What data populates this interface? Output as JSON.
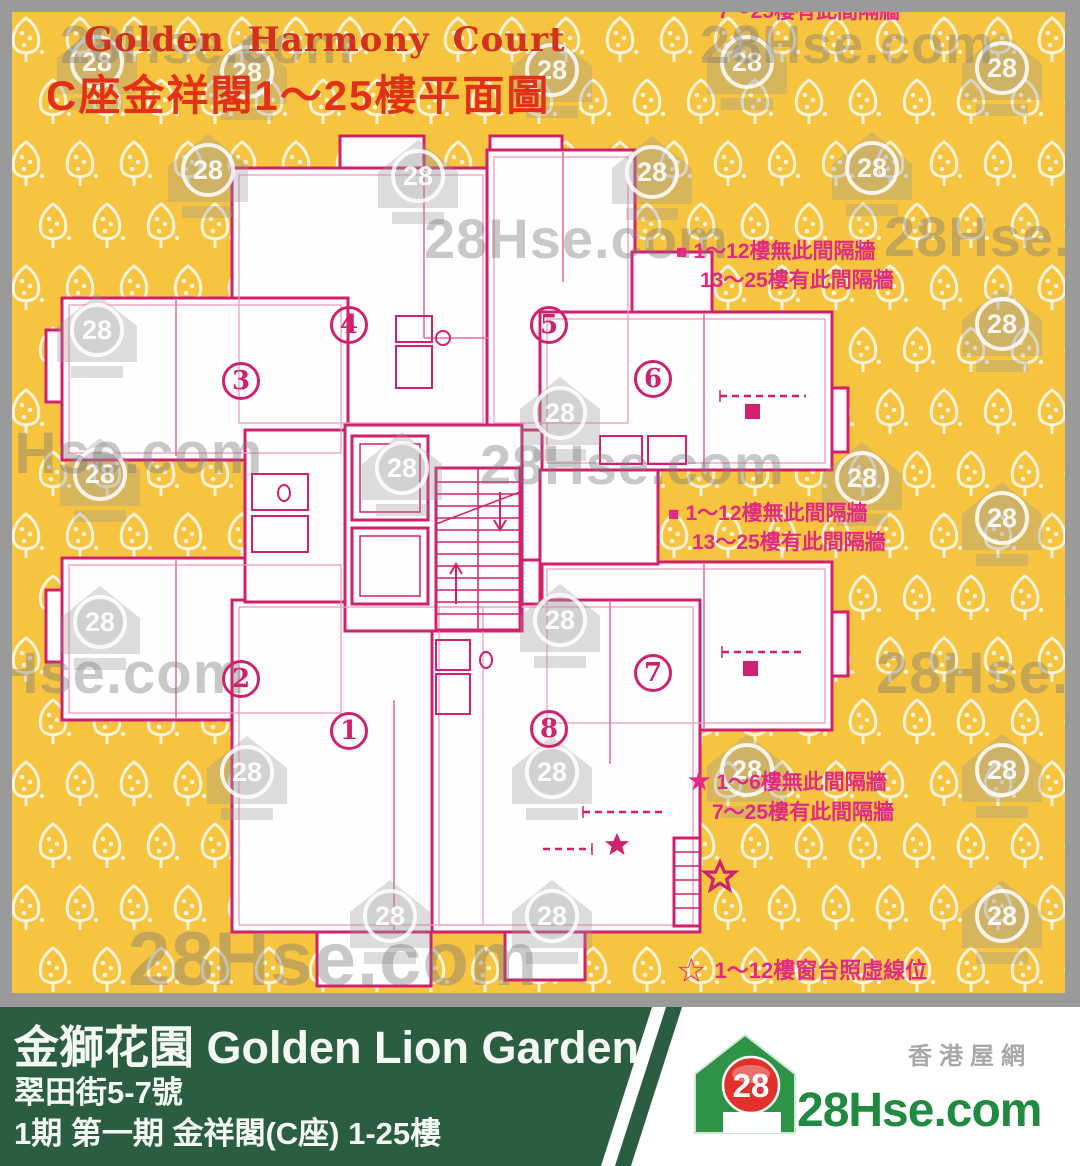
{
  "header": {
    "title_en": "Golden Harmony Court",
    "title_zh": "C座金祥閣1～25樓平面圖"
  },
  "watermark": {
    "text": "28Hse.com",
    "badge": "28"
  },
  "plan": {
    "units": [
      {
        "number": "1"
      },
      {
        "number": "2"
      },
      {
        "number": "3"
      },
      {
        "number": "4"
      },
      {
        "number": "5"
      },
      {
        "number": "6"
      },
      {
        "number": "7"
      },
      {
        "number": "8"
      }
    ]
  },
  "annotations": {
    "top_partial": "7～25樓有此間隔牆",
    "note_a": {
      "marker": "■",
      "line1": "1～12樓無此間隔牆",
      "line2": "13～25樓有此間隔牆"
    },
    "note_b": {
      "marker": "■",
      "line1": "1～12樓無此間隔牆",
      "line2": "13～25樓有此間隔牆"
    },
    "note_c": {
      "marker": "★",
      "line1": "1～6樓無此間隔牆",
      "line2": "7～25樓有此間隔牆"
    },
    "note_d": {
      "marker": "☆",
      "text": "1～12樓窗台照虛線位"
    }
  },
  "footer": {
    "estate_name": "金獅花園 Golden Lion Garden",
    "address": "翠田街5-7號",
    "phase_info": "1期 第一期 金祥閣(C座) 1-25樓",
    "brand": {
      "site_zh": "香港屋網",
      "site_en": "28Hse.com",
      "badge": "28"
    }
  },
  "colors": {
    "background": "#F7C440",
    "wall": "#D0216E",
    "title_red": "#D4301E",
    "subtitle_red": "#E23119",
    "annotation": "#E22A83",
    "footer_green": "#2B5E41",
    "logo_red": "#E2312A",
    "logo_green": "#2E9247",
    "frame_gray": "#9A9A9A"
  }
}
